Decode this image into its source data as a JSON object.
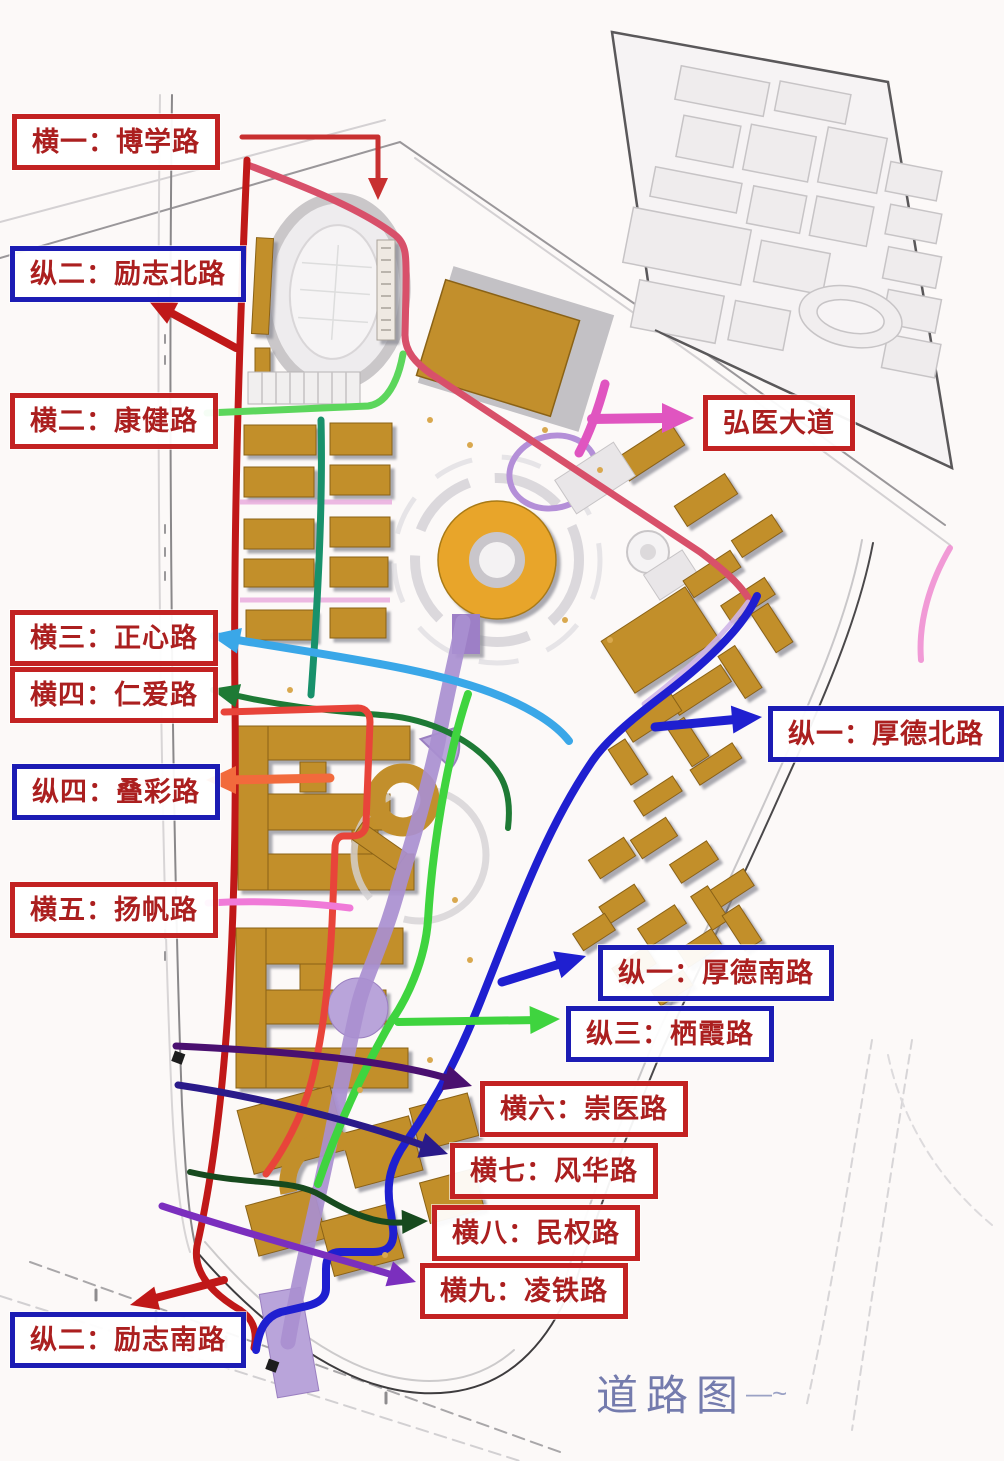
{
  "title": {
    "text": "道路图",
    "color": "#5d66a0",
    "tail_mark": "—~"
  },
  "labels": [
    {
      "id": "heng1",
      "text": "横一：博学路",
      "box": "red",
      "box_color": "#c32222",
      "text_color": "#ab1f1f",
      "arrow_color": "#c83030"
    },
    {
      "id": "zong2n",
      "text": "纵二：励志北路",
      "box": "blue",
      "box_color": "#1c1cb4",
      "text_color": "#ab1f1f",
      "arrow_color": "#c01818"
    },
    {
      "id": "heng2",
      "text": "横二：康健路",
      "box": "red",
      "box_color": "#c32222",
      "text_color": "#ab1f1f",
      "arrow_color": "#5cd65c"
    },
    {
      "id": "hongyi",
      "text": "弘医大道",
      "box": "red",
      "box_color": "#c32222",
      "text_color": "#ab1f1f",
      "arrow_color": "#e055c0"
    },
    {
      "id": "heng3",
      "text": "横三：正心路",
      "box": "red",
      "box_color": "#c32222",
      "text_color": "#ab1f1f",
      "arrow_color": "#3aa7e8"
    },
    {
      "id": "heng4",
      "text": "横四：仁爱路",
      "box": "red",
      "box_color": "#c32222",
      "text_color": "#ab1f1f",
      "arrow_color": "#1e7a35"
    },
    {
      "id": "zong1n",
      "text": "纵一：厚德北路",
      "box": "blue",
      "box_color": "#1c1cb4",
      "text_color": "#ab1f1f",
      "arrow_color": "#1f1fd0"
    },
    {
      "id": "zong4",
      "text": "纵四：叠彩路",
      "box": "blue",
      "box_color": "#1c1cb4",
      "text_color": "#ab1f1f",
      "arrow_color": "#f26a3c"
    },
    {
      "id": "heng5",
      "text": "横五：扬帆路",
      "box": "red",
      "box_color": "#c32222",
      "text_color": "#ab1f1f",
      "arrow_color": "#f07ad8"
    },
    {
      "id": "zong1s",
      "text": "纵一：厚德南路",
      "box": "blue",
      "box_color": "#1c1cb4",
      "text_color": "#ab1f1f",
      "arrow_color": "#1f1fd0"
    },
    {
      "id": "zong3",
      "text": "纵三：栖霞路",
      "box": "blue",
      "box_color": "#1c1cb4",
      "text_color": "#ab1f1f",
      "arrow_color": "#3fd43f"
    },
    {
      "id": "heng6",
      "text": "横六：崇医路",
      "box": "red",
      "box_color": "#c32222",
      "text_color": "#ab1f1f",
      "arrow_color": "#4a1070"
    },
    {
      "id": "heng7",
      "text": "横七：风华路",
      "box": "red",
      "box_color": "#c32222",
      "text_color": "#ab1f1f",
      "arrow_color": "#2a1a8a"
    },
    {
      "id": "heng8",
      "text": "横八：民权路",
      "box": "red",
      "box_color": "#c32222",
      "text_color": "#ab1f1f",
      "arrow_color": "#174a1e"
    },
    {
      "id": "heng9",
      "text": "横九：凌铁路",
      "box": "red",
      "box_color": "#c32222",
      "text_color": "#ab1f1f",
      "arrow_color": "#7b2fbe"
    },
    {
      "id": "zong2s",
      "text": "纵二：励志南路",
      "box": "blue",
      "box_color": "#1c1cb4",
      "text_color": "#ab1f1f",
      "arrow_color": "#c01818"
    }
  ],
  "roads": [
    {
      "name": "博学路",
      "color": "#d8506a"
    },
    {
      "name": "励志北路",
      "color": "#c01818"
    },
    {
      "name": "康健路",
      "color": "#5cd65c"
    },
    {
      "name": "弘医大道",
      "color": "#e055c0"
    },
    {
      "name": "正心路",
      "color": "#3aa7e8"
    },
    {
      "name": "仁爱路",
      "color": "#1e7a35"
    },
    {
      "name": "厚德北路",
      "color": "#1f1fd0"
    },
    {
      "name": "叠彩路",
      "color": "#f26a3c"
    },
    {
      "name": "扬帆路",
      "color": "#f07ad8"
    },
    {
      "name": "厚德南路",
      "color": "#1f1fd0"
    },
    {
      "name": "栖霞路",
      "color": "#3fd43f"
    },
    {
      "name": "崇医路",
      "color": "#4a1070"
    },
    {
      "name": "风华路",
      "color": "#2a1a8a"
    },
    {
      "name": "民权路",
      "color": "#174a1e"
    },
    {
      "name": "凌铁路",
      "color": "#7b2fbe"
    },
    {
      "name": "励志南路",
      "color": "#c01818"
    }
  ]
}
